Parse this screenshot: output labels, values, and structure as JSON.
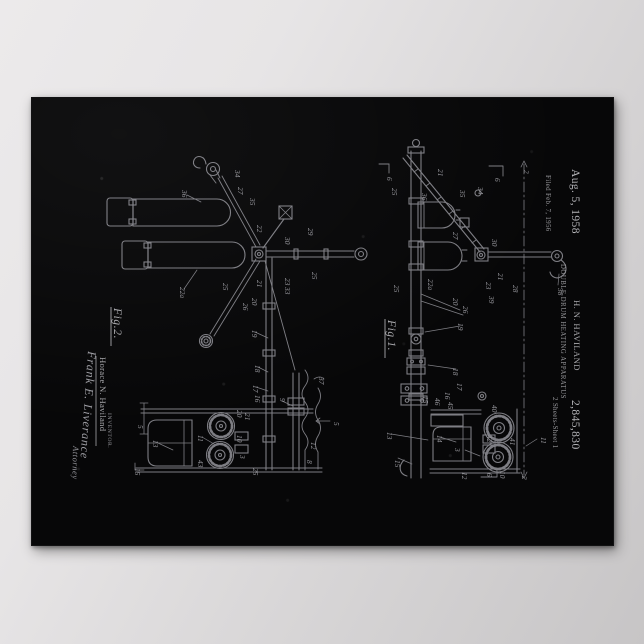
{
  "wall": {
    "background_top": "#eceaeb",
    "background_bottom": "#c7c5c6"
  },
  "poster": {
    "background": "#070708",
    "line_color": "#85858b",
    "header": {
      "date": "Aug. 5, 1958",
      "inventor_name": "H. N. HAVILAND",
      "patent_number": "2,845,830",
      "title": "DOUBLE DRUM HEATING APPARATUS",
      "filed": "Filed Feb. 7, 1956",
      "sheet": "2 Sheets-Sheet 1"
    },
    "figures": {
      "fig1": {
        "label": "Fig.1.",
        "ref_numerals": [
          {
            "t": "6",
            "x": 355,
            "y": 79
          },
          {
            "t": "25",
            "x": 360,
            "y": 90
          },
          {
            "t": "36",
            "x": 390,
            "y": 95
          },
          {
            "t": "21",
            "x": 406,
            "y": 71
          },
          {
            "t": "35",
            "x": 428,
            "y": 92
          },
          {
            "t": "34",
            "x": 446,
            "y": 89
          },
          {
            "t": "6",
            "x": 463,
            "y": 80
          },
          {
            "t": "2",
            "x": 492,
            "y": 72
          },
          {
            "t": "27",
            "x": 421,
            "y": 134
          },
          {
            "t": "30",
            "x": 460,
            "y": 141
          },
          {
            "t": "22a",
            "x": 396,
            "y": 181
          },
          {
            "t": "25",
            "x": 362,
            "y": 187
          },
          {
            "t": "21",
            "x": 466,
            "y": 175
          },
          {
            "t": "23",
            "x": 454,
            "y": 184
          },
          {
            "t": "28",
            "x": 481,
            "y": 187
          },
          {
            "t": "39",
            "x": 457,
            "y": 198
          },
          {
            "t": "38",
            "x": 526,
            "y": 190
          },
          {
            "t": "20",
            "x": 421,
            "y": 200
          },
          {
            "t": "26",
            "x": 431,
            "y": 208
          },
          {
            "t": "19",
            "x": 426,
            "y": 225
          },
          {
            "t": "18",
            "x": 421,
            "y": 270
          },
          {
            "t": "17",
            "x": 425,
            "y": 285
          },
          {
            "t": "16",
            "x": 413,
            "y": 294
          },
          {
            "t": "46",
            "x": 403,
            "y": 300
          },
          {
            "t": "15",
            "x": 391,
            "y": 298
          },
          {
            "t": "45",
            "x": 416,
            "y": 304
          },
          {
            "t": "13",
            "x": 355,
            "y": 334
          },
          {
            "t": "14",
            "x": 405,
            "y": 337
          },
          {
            "t": "40",
            "x": 460,
            "y": 307
          },
          {
            "t": "42",
            "x": 455,
            "y": 337
          },
          {
            "t": "41",
            "x": 478,
            "y": 340
          },
          {
            "t": "11",
            "x": 509,
            "y": 339
          },
          {
            "t": "3",
            "x": 423,
            "y": 350
          },
          {
            "t": "12",
            "x": 430,
            "y": 374
          },
          {
            "t": "10",
            "x": 468,
            "y": 373
          },
          {
            "t": "15",
            "x": 363,
            "y": 362
          },
          {
            "t": "6",
            "x": 455,
            "y": 375
          },
          {
            "t": "2",
            "x": 490,
            "y": 378
          }
        ]
      },
      "fig2": {
        "label": "Fig.2.",
        "ref_numerals": [
          {
            "t": "34",
            "x": 203,
            "y": 72
          },
          {
            "t": "27",
            "x": 206,
            "y": 89
          },
          {
            "t": "35",
            "x": 218,
            "y": 100
          },
          {
            "t": "36",
            "x": 150,
            "y": 92
          },
          {
            "t": "22",
            "x": 225,
            "y": 127
          },
          {
            "t": "30",
            "x": 253,
            "y": 139
          },
          {
            "t": "29",
            "x": 276,
            "y": 130
          },
          {
            "t": "25",
            "x": 280,
            "y": 174
          },
          {
            "t": "23",
            "x": 253,
            "y": 180
          },
          {
            "t": "22a",
            "x": 148,
            "y": 189
          },
          {
            "t": "25",
            "x": 191,
            "y": 185
          },
          {
            "t": "21",
            "x": 225,
            "y": 182
          },
          {
            "t": "20",
            "x": 220,
            "y": 200
          },
          {
            "t": "26",
            "x": 211,
            "y": 205
          },
          {
            "t": "33",
            "x": 253,
            "y": 189
          },
          {
            "t": "19",
            "x": 220,
            "y": 232
          },
          {
            "t": "18",
            "x": 223,
            "y": 267
          },
          {
            "t": "17",
            "x": 221,
            "y": 287
          },
          {
            "t": "16",
            "x": 223,
            "y": 297
          },
          {
            "t": "9",
            "x": 248,
            "y": 300
          },
          {
            "t": "37",
            "x": 287,
            "y": 279
          },
          {
            "t": "20",
            "x": 205,
            "y": 312
          },
          {
            "t": "21",
            "x": 213,
            "y": 315
          },
          {
            "t": "10",
            "x": 205,
            "y": 337
          },
          {
            "t": "11",
            "x": 166,
            "y": 337
          },
          {
            "t": "13",
            "x": 121,
            "y": 342
          },
          {
            "t": "43",
            "x": 166,
            "y": 362
          },
          {
            "t": "3",
            "x": 208,
            "y": 357
          },
          {
            "t": "12",
            "x": 279,
            "y": 344
          },
          {
            "t": "8",
            "x": 275,
            "y": 362
          },
          {
            "t": "5",
            "x": 106,
            "y": 327
          },
          {
            "t": "5",
            "x": 302,
            "y": 324
          },
          {
            "t": "25",
            "x": 221,
            "y": 370
          },
          {
            "t": "15",
            "x": 103,
            "y": 370
          }
        ]
      }
    },
    "signature_block": {
      "caption": "INVENTOR.",
      "inventor": "Horace N. Haviland",
      "signature": "Frank E. Liverance",
      "attorney": "Attorney"
    }
  }
}
